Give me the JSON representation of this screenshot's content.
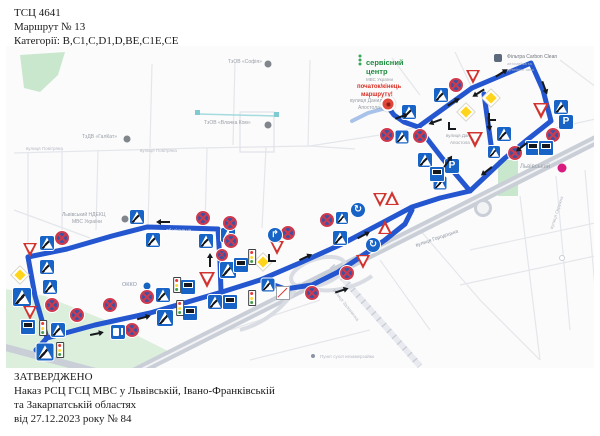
{
  "header": {
    "line1": "ТСЦ 4641",
    "line2": "Маршрут № 13",
    "line3": "Категорії: B,C1,C,D1,D,BE,C1E,CE"
  },
  "footer": {
    "line1": "ЗАТВЕРДЖЕНО",
    "line2": "Наказ РСЦ ГСЦ МВС у Львівській, Івано-Франківській",
    "line3": "та Закарпатській областях",
    "line4": "від 27.12.2023 року № 84"
  },
  "map": {
    "colors": {
      "route": "#2356cf",
      "route_light": "#a9c2ea"
    },
    "route_segments": [
      [
        [
          36,
          350
        ],
        [
          47,
          338
        ],
        [
          95,
          325
        ],
        [
          150,
          313
        ],
        [
          222,
          292
        ],
        [
          260,
          280
        ],
        [
          302,
          262
        ],
        [
          342,
          244
        ],
        [
          380,
          224
        ],
        [
          412,
          207
        ],
        [
          440,
          198
        ],
        [
          470,
          191
        ]
      ],
      [
        [
          28,
          257
        ],
        [
          67,
          249
        ],
        [
          112,
          236
        ],
        [
          147,
          227
        ],
        [
          186,
          228
        ],
        [
          218,
          229
        ],
        [
          220,
          262
        ],
        [
          221,
          292
        ]
      ],
      [
        [
          28,
          257
        ],
        [
          35,
          296
        ],
        [
          47,
          338
        ]
      ],
      [
        [
          418,
          127
        ],
        [
          472,
          88
        ],
        [
          531,
          63
        ],
        [
          543,
          90
        ],
        [
          551,
          121
        ],
        [
          527,
          140
        ],
        [
          505,
          158
        ],
        [
          470,
          191
        ],
        [
          442,
          158
        ],
        [
          418,
          127
        ]
      ],
      [
        [
          484,
          94
        ],
        [
          492,
          152
        ]
      ],
      [
        [
          388,
          107
        ],
        [
          394,
          115
        ],
        [
          404,
          122
        ],
        [
          418,
          127
        ]
      ],
      [
        [
          260,
          280
        ],
        [
          285,
          289
        ],
        [
          312,
          285
        ],
        [
          338,
          272
        ],
        [
          362,
          256
        ],
        [
          385,
          240
        ],
        [
          405,
          224
        ],
        [
          412,
          210
        ]
      ]
    ],
    "route_light_segments": [
      [
        [
          352,
          121
        ],
        [
          368,
          113
        ],
        [
          386,
          108
        ]
      ]
    ],
    "sign_glyphs": {
      "pk": "P",
      "mr": "↱",
      "rb": "↻"
    },
    "signs": [
      {
        "t": "ped",
        "x": 137,
        "y": 217
      },
      {
        "t": "ped",
        "x": 153,
        "y": 240
      },
      {
        "t": "ped",
        "x": 206,
        "y": 241
      },
      {
        "t": "ped",
        "x": 47,
        "y": 243
      },
      {
        "t": "ped",
        "x": 47,
        "y": 267
      },
      {
        "t": "ped",
        "x": 22,
        "y": 297,
        "s": 18
      },
      {
        "t": "ped",
        "x": 50,
        "y": 287
      },
      {
        "t": "ped",
        "x": 58,
        "y": 330
      },
      {
        "t": "ped",
        "x": 45,
        "y": 352,
        "s": 17
      },
      {
        "t": "ped",
        "x": 165,
        "y": 318,
        "s": 16
      },
      {
        "t": "ped",
        "x": 215,
        "y": 302
      },
      {
        "t": "ped",
        "x": 163,
        "y": 295
      },
      {
        "t": "ped",
        "x": 228,
        "y": 235
      },
      {
        "t": "ped",
        "x": 228,
        "y": 270,
        "s": 16
      },
      {
        "t": "ped",
        "x": 340,
        "y": 238
      },
      {
        "t": "ped",
        "x": 342,
        "y": 218,
        "s": 12
      },
      {
        "t": "ped",
        "x": 268,
        "y": 285,
        "s": 13
      },
      {
        "t": "ped",
        "x": 425,
        "y": 160
      },
      {
        "t": "ped",
        "x": 441,
        "y": 95
      },
      {
        "t": "ped",
        "x": 409,
        "y": 112
      },
      {
        "t": "ped",
        "x": 402,
        "y": 137,
        "s": 13
      },
      {
        "t": "ped",
        "x": 504,
        "y": 134
      },
      {
        "t": "ped",
        "x": 561,
        "y": 107
      },
      {
        "t": "ped",
        "x": 494,
        "y": 152,
        "s": 12
      },
      {
        "t": "ped",
        "x": 440,
        "y": 183,
        "s": 13
      },
      {
        "t": "ns",
        "x": 203,
        "y": 218
      },
      {
        "t": "ns",
        "x": 230,
        "y": 223
      },
      {
        "t": "ns",
        "x": 62,
        "y": 238
      },
      {
        "t": "ns",
        "x": 231,
        "y": 241
      },
      {
        "t": "ns",
        "x": 52,
        "y": 305
      },
      {
        "t": "ns",
        "x": 77,
        "y": 315
      },
      {
        "t": "ns",
        "x": 110,
        "y": 305
      },
      {
        "t": "ns",
        "x": 147,
        "y": 297
      },
      {
        "t": "ns",
        "x": 132,
        "y": 330
      },
      {
        "t": "ns",
        "x": 222,
        "y": 255,
        "s": 12
      },
      {
        "t": "ns",
        "x": 288,
        "y": 233
      },
      {
        "t": "ns",
        "x": 327,
        "y": 220
      },
      {
        "t": "ns",
        "x": 347,
        "y": 273
      },
      {
        "t": "ns",
        "x": 312,
        "y": 293
      },
      {
        "t": "ns",
        "x": 553,
        "y": 135
      },
      {
        "t": "ns",
        "x": 456,
        "y": 85
      },
      {
        "t": "ns",
        "x": 387,
        "y": 135
      },
      {
        "t": "ns",
        "x": 420,
        "y": 136
      },
      {
        "t": "ns",
        "x": 515,
        "y": 153
      },
      {
        "t": "yl",
        "x": 30,
        "y": 250
      },
      {
        "t": "yl",
        "x": 30,
        "y": 313
      },
      {
        "t": "yl",
        "x": 207,
        "y": 280,
        "s": 16
      },
      {
        "t": "yl",
        "x": 277,
        "y": 248
      },
      {
        "t": "yl",
        "x": 363,
        "y": 262
      },
      {
        "t": "yl",
        "x": 380,
        "y": 200
      },
      {
        "t": "yl",
        "x": 473,
        "y": 77
      },
      {
        "t": "yl",
        "x": 541,
        "y": 111,
        "s": 16
      },
      {
        "t": "yl",
        "x": 475,
        "y": 140,
        "s": 16
      },
      {
        "t": "wr",
        "x": 392,
        "y": 198
      },
      {
        "t": "wr",
        "x": 385,
        "y": 227
      },
      {
        "t": "dm",
        "x": 20,
        "y": 275,
        "s": 12
      },
      {
        "t": "dm",
        "x": 263,
        "y": 262,
        "s": 12
      },
      {
        "t": "dm",
        "x": 466,
        "y": 112,
        "s": 12
      },
      {
        "t": "dm",
        "x": 491,
        "y": 98,
        "s": 12
      },
      {
        "t": "pk",
        "x": 566,
        "y": 122
      },
      {
        "t": "pk",
        "x": 452,
        "y": 166
      },
      {
        "t": "bs",
        "x": 28,
        "y": 327
      },
      {
        "t": "bs",
        "x": 190,
        "y": 313
      },
      {
        "t": "bs",
        "x": 230,
        "y": 302
      },
      {
        "t": "bs",
        "x": 241,
        "y": 265
      },
      {
        "t": "bs",
        "x": 188,
        "y": 287
      },
      {
        "t": "bs",
        "x": 533,
        "y": 148
      },
      {
        "t": "bs",
        "x": 546,
        "y": 148
      },
      {
        "t": "bs",
        "x": 437,
        "y": 174
      },
      {
        "t": "tl",
        "x": 43,
        "y": 328
      },
      {
        "t": "tl",
        "x": 60,
        "y": 350
      },
      {
        "t": "tl",
        "x": 177,
        "y": 285
      },
      {
        "t": "tl",
        "x": 180,
        "y": 308
      },
      {
        "t": "tl",
        "x": 252,
        "y": 257
      },
      {
        "t": "tl",
        "x": 252,
        "y": 298
      },
      {
        "t": "mr",
        "x": 275,
        "y": 235
      },
      {
        "t": "rb",
        "x": 358,
        "y": 210
      },
      {
        "t": "rb",
        "x": 373,
        "y": 245
      },
      {
        "t": "gs",
        "x": 118,
        "y": 332
      },
      {
        "t": "sl",
        "x": 283,
        "y": 293
      }
    ],
    "labels": [
      {
        "t": "ТзОВ «Софія»",
        "x": 228,
        "y": 59,
        "s": 5
      },
      {
        "t": "ТзОВ «Влачка Ком»",
        "x": 204,
        "y": 120,
        "s": 5
      },
      {
        "t": "ТзДВ «ГалКат»",
        "x": 82,
        "y": 134,
        "s": 5
      },
      {
        "t": "вулиця Повітряна",
        "x": 26,
        "y": 146,
        "s": 4.5,
        "c": "#b6bac2"
      },
      {
        "t": "вулиця Повітряна",
        "x": 140,
        "y": 148,
        "s": 4.5,
        "c": "#b6bac2"
      },
      {
        "t": "Львівський НДЕКЦ",
        "x": 62,
        "y": 212,
        "s": 5
      },
      {
        "t": "МВС України",
        "x": 72,
        "y": 219,
        "s": 5
      },
      {
        "t": "Зберігальна",
        "x": 166,
        "y": 228,
        "s": 4.5,
        "c": "#ffffff"
      },
      {
        "t": "вулиця Данила",
        "x": 350,
        "y": 98,
        "s": 5
      },
      {
        "t": "Апостола",
        "x": 358,
        "y": 105,
        "s": 5
      },
      {
        "t": "сервісний",
        "x": 366,
        "y": 58,
        "s": 7.5,
        "c": "#1e8e3e",
        "b": 1
      },
      {
        "t": "центр",
        "x": 366,
        "y": 67,
        "s": 7.5,
        "c": "#1e8e3e",
        "b": 1
      },
      {
        "t": "МВС України",
        "x": 366,
        "y": 77,
        "s": 4.5
      },
      {
        "t": "початок/кінець",
        "x": 357,
        "y": 84,
        "s": 6,
        "c": "#d93025",
        "b": 1
      },
      {
        "t": "маршруту!",
        "x": 361,
        "y": 92,
        "s": 6,
        "c": "#d93025",
        "b": 1
      },
      {
        "t": "вулиця Данила",
        "x": 446,
        "y": 133,
        "s": 4.5
      },
      {
        "t": "Апостола",
        "x": 450,
        "y": 140,
        "s": 4.5
      },
      {
        "t": "Фільтра Carbon Clean",
        "x": 507,
        "y": 54,
        "s": 5,
        "c": "#70757a"
      },
      {
        "t": "автомийка та",
        "x": 507,
        "y": 61,
        "s": 4,
        "c": "#b6bac2"
      },
      {
        "t": "детейлінг авто",
        "x": 507,
        "y": 67,
        "s": 4,
        "c": "#b6bac2"
      },
      {
        "t": "Львівський",
        "x": 520,
        "y": 164,
        "s": 6
      },
      {
        "t": "ОККО",
        "x": 122,
        "y": 282,
        "s": 5.5,
        "c": "#8a93a6"
      },
      {
        "t": "вулиця Городоцька",
        "x": 415,
        "y": 243,
        "s": 5,
        "c": "#8d94a0",
        "r": -19
      },
      {
        "t": "вулиця Залізнична",
        "x": 336,
        "y": 288,
        "s": 4.5,
        "c": "#b6bac2",
        "r": 52
      },
      {
        "t": "вулиця Окружна",
        "x": 549,
        "y": 228,
        "s": 4.5,
        "c": "#b6bac2",
        "r": -72
      },
      {
        "t": "Пункт сухої незамерзайки",
        "x": 320,
        "y": 354,
        "s": 4.5,
        "c": "#b6bac2"
      }
    ],
    "poi_dots": [
      {
        "x": 268,
        "y": 64,
        "c": "#80868b",
        "r": 3.5
      },
      {
        "x": 268,
        "y": 125,
        "c": "#80868b",
        "r": 3.5
      },
      {
        "x": 127,
        "y": 139,
        "c": "#80868b",
        "r": 3.5
      },
      {
        "x": 125,
        "y": 219,
        "c": "#80868b",
        "r": 3.5
      },
      {
        "x": 147,
        "y": 286,
        "c": "#1565c0",
        "r": 3.5
      },
      {
        "x": 562,
        "y": 168,
        "c": "#d81b7f",
        "r": 4.5
      },
      {
        "x": 313,
        "y": 356,
        "c": "#8a93a6",
        "r": 2
      },
      {
        "x": 562,
        "y": 258,
        "c": "#ffffff",
        "r": 3,
        "b": "#c9ced7"
      },
      {
        "x": 498,
        "y": 58,
        "c": "#5b6b7d",
        "r": 4,
        "sq": 1
      },
      {
        "x": 360,
        "y": 56,
        "c": "#34a853",
        "r": 1.5,
        "sq": 1
      },
      {
        "x": 360,
        "y": 60,
        "c": "#34a853",
        "r": 1.5,
        "sq": 1
      },
      {
        "x": 360,
        "y": 64,
        "c": "#34a853",
        "r": 1.5,
        "sq": 1
      }
    ],
    "arrows": [
      [
        165,
        222,
        180
      ],
      [
        210,
        262,
        -90
      ],
      [
        142,
        318,
        -15
      ],
      [
        95,
        334,
        -12
      ],
      [
        340,
        291,
        -18
      ],
      [
        452,
        103,
        -32
      ],
      [
        500,
        74,
        -32
      ],
      [
        480,
        92,
        148
      ],
      [
        544,
        86,
        70
      ],
      [
        523,
        146,
        142
      ],
      [
        488,
        170,
        142
      ],
      [
        447,
        163,
        -55
      ],
      [
        400,
        117,
        -20
      ],
      [
        437,
        121,
        160
      ],
      [
        304,
        258,
        -25
      ],
      [
        362,
        236,
        -28
      ],
      [
        489,
        122,
        85
      ]
    ],
    "corners": [
      [
        268,
        254
      ],
      [
        488,
        113
      ],
      [
        448,
        122
      ]
    ],
    "start_marker": {
      "x": 388,
      "y": 104
    }
  }
}
